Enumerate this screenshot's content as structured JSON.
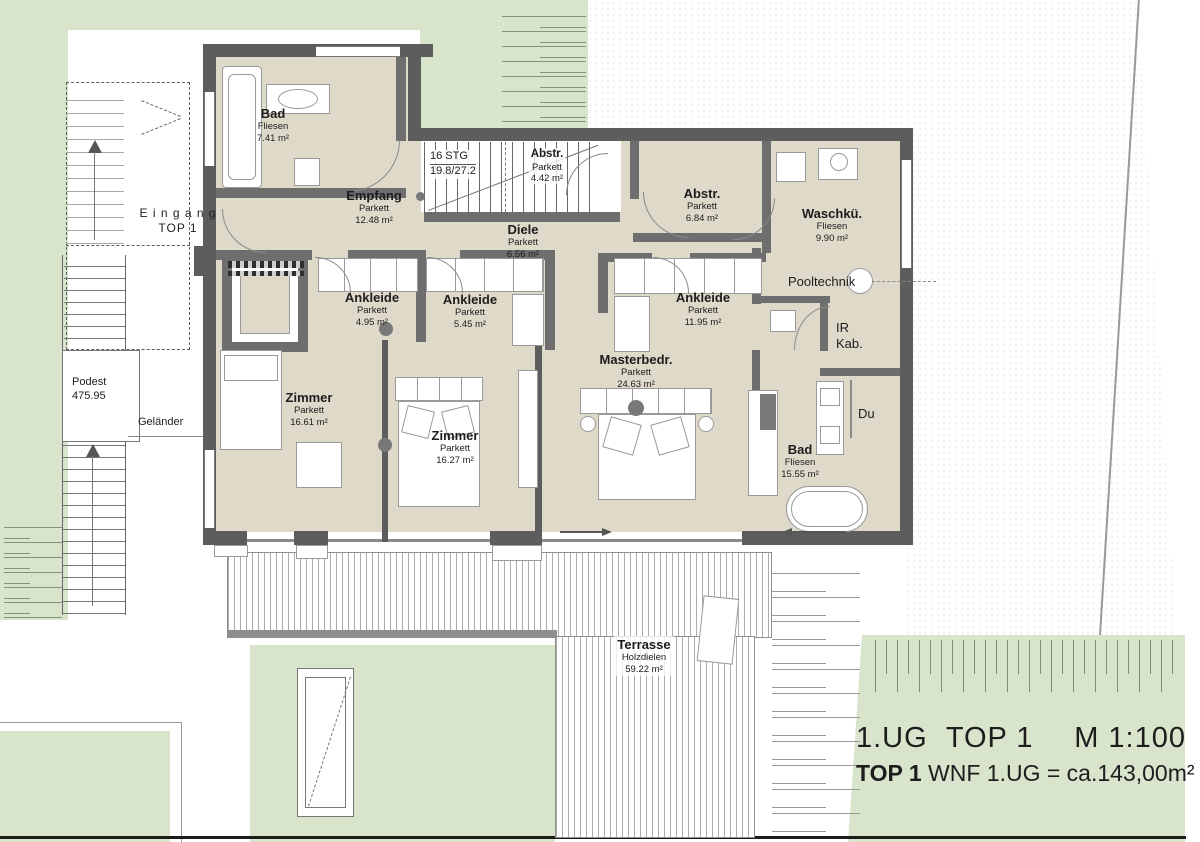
{
  "title_block": {
    "floor": "1.UG",
    "unit": "TOP 1",
    "scale": "M  1:100",
    "line2_prefix": "TOP 1",
    "line2_text": " WNF 1.UG = ca.143,00m²"
  },
  "rooms": [
    {
      "name": "Bad",
      "finish": "Fliesen",
      "area": "7.41 m²"
    },
    {
      "name": "Empfang",
      "finish": "Parkett",
      "area": "12.48 m²"
    },
    {
      "name": "Abstr.",
      "finish": "Parkett",
      "area": "4.42 m²"
    },
    {
      "name": "Diele",
      "finish": "Parkett",
      "area": "6.56 m²"
    },
    {
      "name": "Abstr.",
      "finish": "Parkett",
      "area": "6.84 m²"
    },
    {
      "name": "Waschkü.",
      "finish": "Fliesen",
      "area": "9.90 m²"
    },
    {
      "name": "Ankleide",
      "finish": "Parkett",
      "area": "4.95 m²"
    },
    {
      "name": "Ankleide",
      "finish": "Parkett",
      "area": "5.45 m²"
    },
    {
      "name": "Ankleide",
      "finish": "Parkett",
      "area": "11.95 m²"
    },
    {
      "name": "Masterbedr.",
      "finish": "Parkett",
      "area": "24.63 m²"
    },
    {
      "name": "Zimmer",
      "finish": "Parkett",
      "area": "16.61 m²"
    },
    {
      "name": "Zimmer",
      "finish": "Parkett",
      "area": "16.27 m²"
    },
    {
      "name": "Bad",
      "finish": "Fliesen",
      "area": "15.55 m²"
    },
    {
      "name": "Terrasse",
      "finish": "Holzdielen",
      "area": "59.22 m²"
    }
  ],
  "annotations": {
    "eingang_line1": "E i n g a n g",
    "eingang_line2": "TOP 1",
    "podest": "Podest",
    "podest_elev": "475.95",
    "gelaender": "Geländer",
    "stairs_line1": "16 STG",
    "stairs_line2": "19.8/27.2",
    "pooltechnik": "Pooltechnik",
    "ir_line1": "IR",
    "ir_line2": "Kab.",
    "du": "Du"
  },
  "colors": {
    "grass": "#d8e4cb",
    "floor": "#ded9c9",
    "wall": "#5d5d5d",
    "boundary": "#1c1c1c"
  }
}
